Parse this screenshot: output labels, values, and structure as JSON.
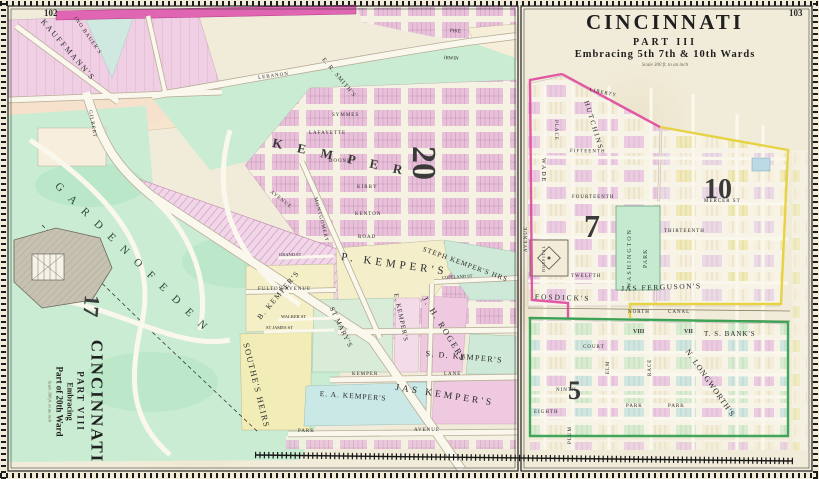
{
  "sheet": {
    "left_page_number": "102",
    "right_page_number": "103"
  },
  "left_panel": {
    "title": {
      "city": "CINCINNATI",
      "part": "PART VIII",
      "embracing": "Embracing",
      "ward_line": "Part of 20th Ward",
      "scale": "Scale 300 ft. to an inch"
    },
    "ward_numbers": {
      "seventeen": "17",
      "twenty": "20"
    },
    "park_label": "G A R D E N   O F   E D E N",
    "kemper_spread": "K E M P E R",
    "owners": {
      "kauffmanns": "KAUFFMANN'S",
      "jno_bauers": "JNO BAUER'S",
      "er_smiths": "E. R. SMITH'S",
      "p_kempers": "P. KEMPER'S",
      "steph_kempers": "STEPH KEMPER'S HRS",
      "jh_rogers": "J. H. ROGERS",
      "sd_kempers": "S. D. KEMPER'S",
      "e_kempers": "E. KEMPER'S",
      "st_marys": "ST MARY'S",
      "b_kempers": "B. KEMPER'S",
      "southes_heirs": "SOUTHE'S HEIRS",
      "ea_kempers": "E. A. KEMPER'S",
      "jas_kempers": "JAS KEMPER'S"
    },
    "streets": {
      "lebanon": "LEBANON",
      "gilbert": "GILBERT",
      "avenue": "AVENUE",
      "pike": "PIKE",
      "irwin": "IRWIN",
      "symmes": "SYMMES",
      "lafayette": "LAFAYETTE",
      "boone": "BOONE",
      "kirby": "KIRBY",
      "kenton": "KENTON",
      "road": "ROAD",
      "montgomery": "MONTGOMERY",
      "fulton_avenue": "FULTON AVENUE",
      "grand_st": "GRAND ST",
      "walker_st": "WALKER ST",
      "st_james_st": "ST JAMES ST",
      "kemper": "KEMPER",
      "lane": "LANE",
      "copeland_st": "COPELAND ST",
      "park": "PARK",
      "avenue2": "AVENUE"
    }
  },
  "right_panel": {
    "title": {
      "city": "CINCINNATI",
      "part": "PART III",
      "embracing": "Embracing 5th 7th & 10th Wards",
      "scale": "Scale 300 ft. to an inch"
    },
    "ward_numbers": {
      "five": "5",
      "seven": "7",
      "ten": "10"
    },
    "blocks": {
      "viii": "VIII",
      "vii": "VII"
    },
    "places": {
      "washington": "WASHINGTON",
      "park": "PARK",
      "hospital": "HOSPITAL",
      "park_small_1": "PARK",
      "park_small_2": "PARK"
    },
    "owners": {
      "fosdicks": "FOSDICK'S",
      "jas_fergusons": "JAS FERGUSON'S",
      "ts_banks": "T. S. BANK'S",
      "n_longworths": "N. LONGWORTH'S",
      "wade": "WADE",
      "place": "PLACE"
    },
    "streets": {
      "liberty": "LIBERTY",
      "hutchins": "HUTCHINS",
      "fifteenth": "FIFTEENTH",
      "fourteenth": "FOURTEENTH",
      "thirteenth": "THIRTEENTH",
      "twelfth": "TWELFTH",
      "mercer_st": "MERCER ST",
      "north": "NORTH",
      "canal": "CANAL",
      "court": "COURT",
      "ninth": "NINTH",
      "eighth": "EIGHTH",
      "elm": "ELM",
      "race": "RACE",
      "plum": "PLUM",
      "avenue": "AVENUE"
    }
  }
}
